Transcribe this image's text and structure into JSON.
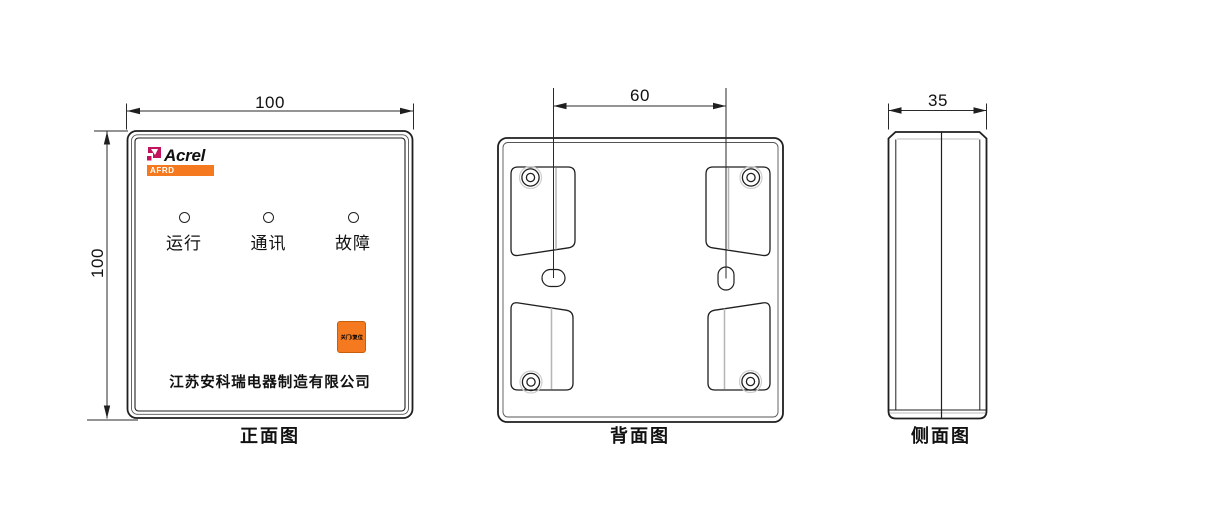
{
  "colors": {
    "accent_orange": "#F4791F",
    "brand_crimson": "#C2145C",
    "line_black": "#1F1F1F",
    "seam_gray": "#B5B5B5"
  },
  "front": {
    "view_label": "正面图",
    "dim_width": "100",
    "dim_height": "100",
    "brand": "Acrel",
    "series": "AFRD",
    "led_labels": [
      "运行",
      "通讯",
      "故障"
    ],
    "button_label": "关门/复位",
    "company": "江苏安科瑞电器制造有限公司"
  },
  "back": {
    "view_label": "背面图",
    "dim_hole_spacing": "60"
  },
  "side": {
    "view_label": "侧面图",
    "dim_depth": "35"
  }
}
